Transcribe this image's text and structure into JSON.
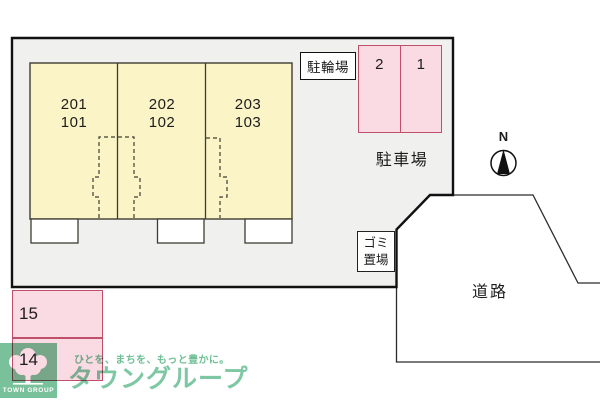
{
  "plan": {
    "building": {
      "units": [
        {
          "upper": "201",
          "lower": "101"
        },
        {
          "upper": "202",
          "lower": "102"
        },
        {
          "upper": "203",
          "lower": "103"
        }
      ]
    },
    "bicycle_parking_label": "駐輪場",
    "car_parking_label": "駐車場",
    "garbage_label": {
      "line1": "ゴミ",
      "line2": "置場"
    },
    "road_label": "道路",
    "compass_north_label": "N",
    "parking_spaces_right": [
      "2",
      "1"
    ],
    "parking_spaces_left": [
      "15",
      "14"
    ]
  },
  "footer": {
    "logo_text": "TOWN GROUP",
    "tagline": "ひとを、まちを、もっと豊かに。",
    "brand": "タウングループ"
  },
  "colors": {
    "site_fill": "#f0f0ee",
    "site_stroke": "#111111",
    "building_fill": "#fbf4c6",
    "building_stroke": "#3d3d32",
    "space_fill": "#fbdbe3",
    "space_stroke": "#c0506a",
    "line": "#2b2b2b",
    "text": "#1c1c1c",
    "logo_green": "#79c19a",
    "brand_green": "#7ec7a3",
    "tagline_green": "#6fbf96"
  }
}
